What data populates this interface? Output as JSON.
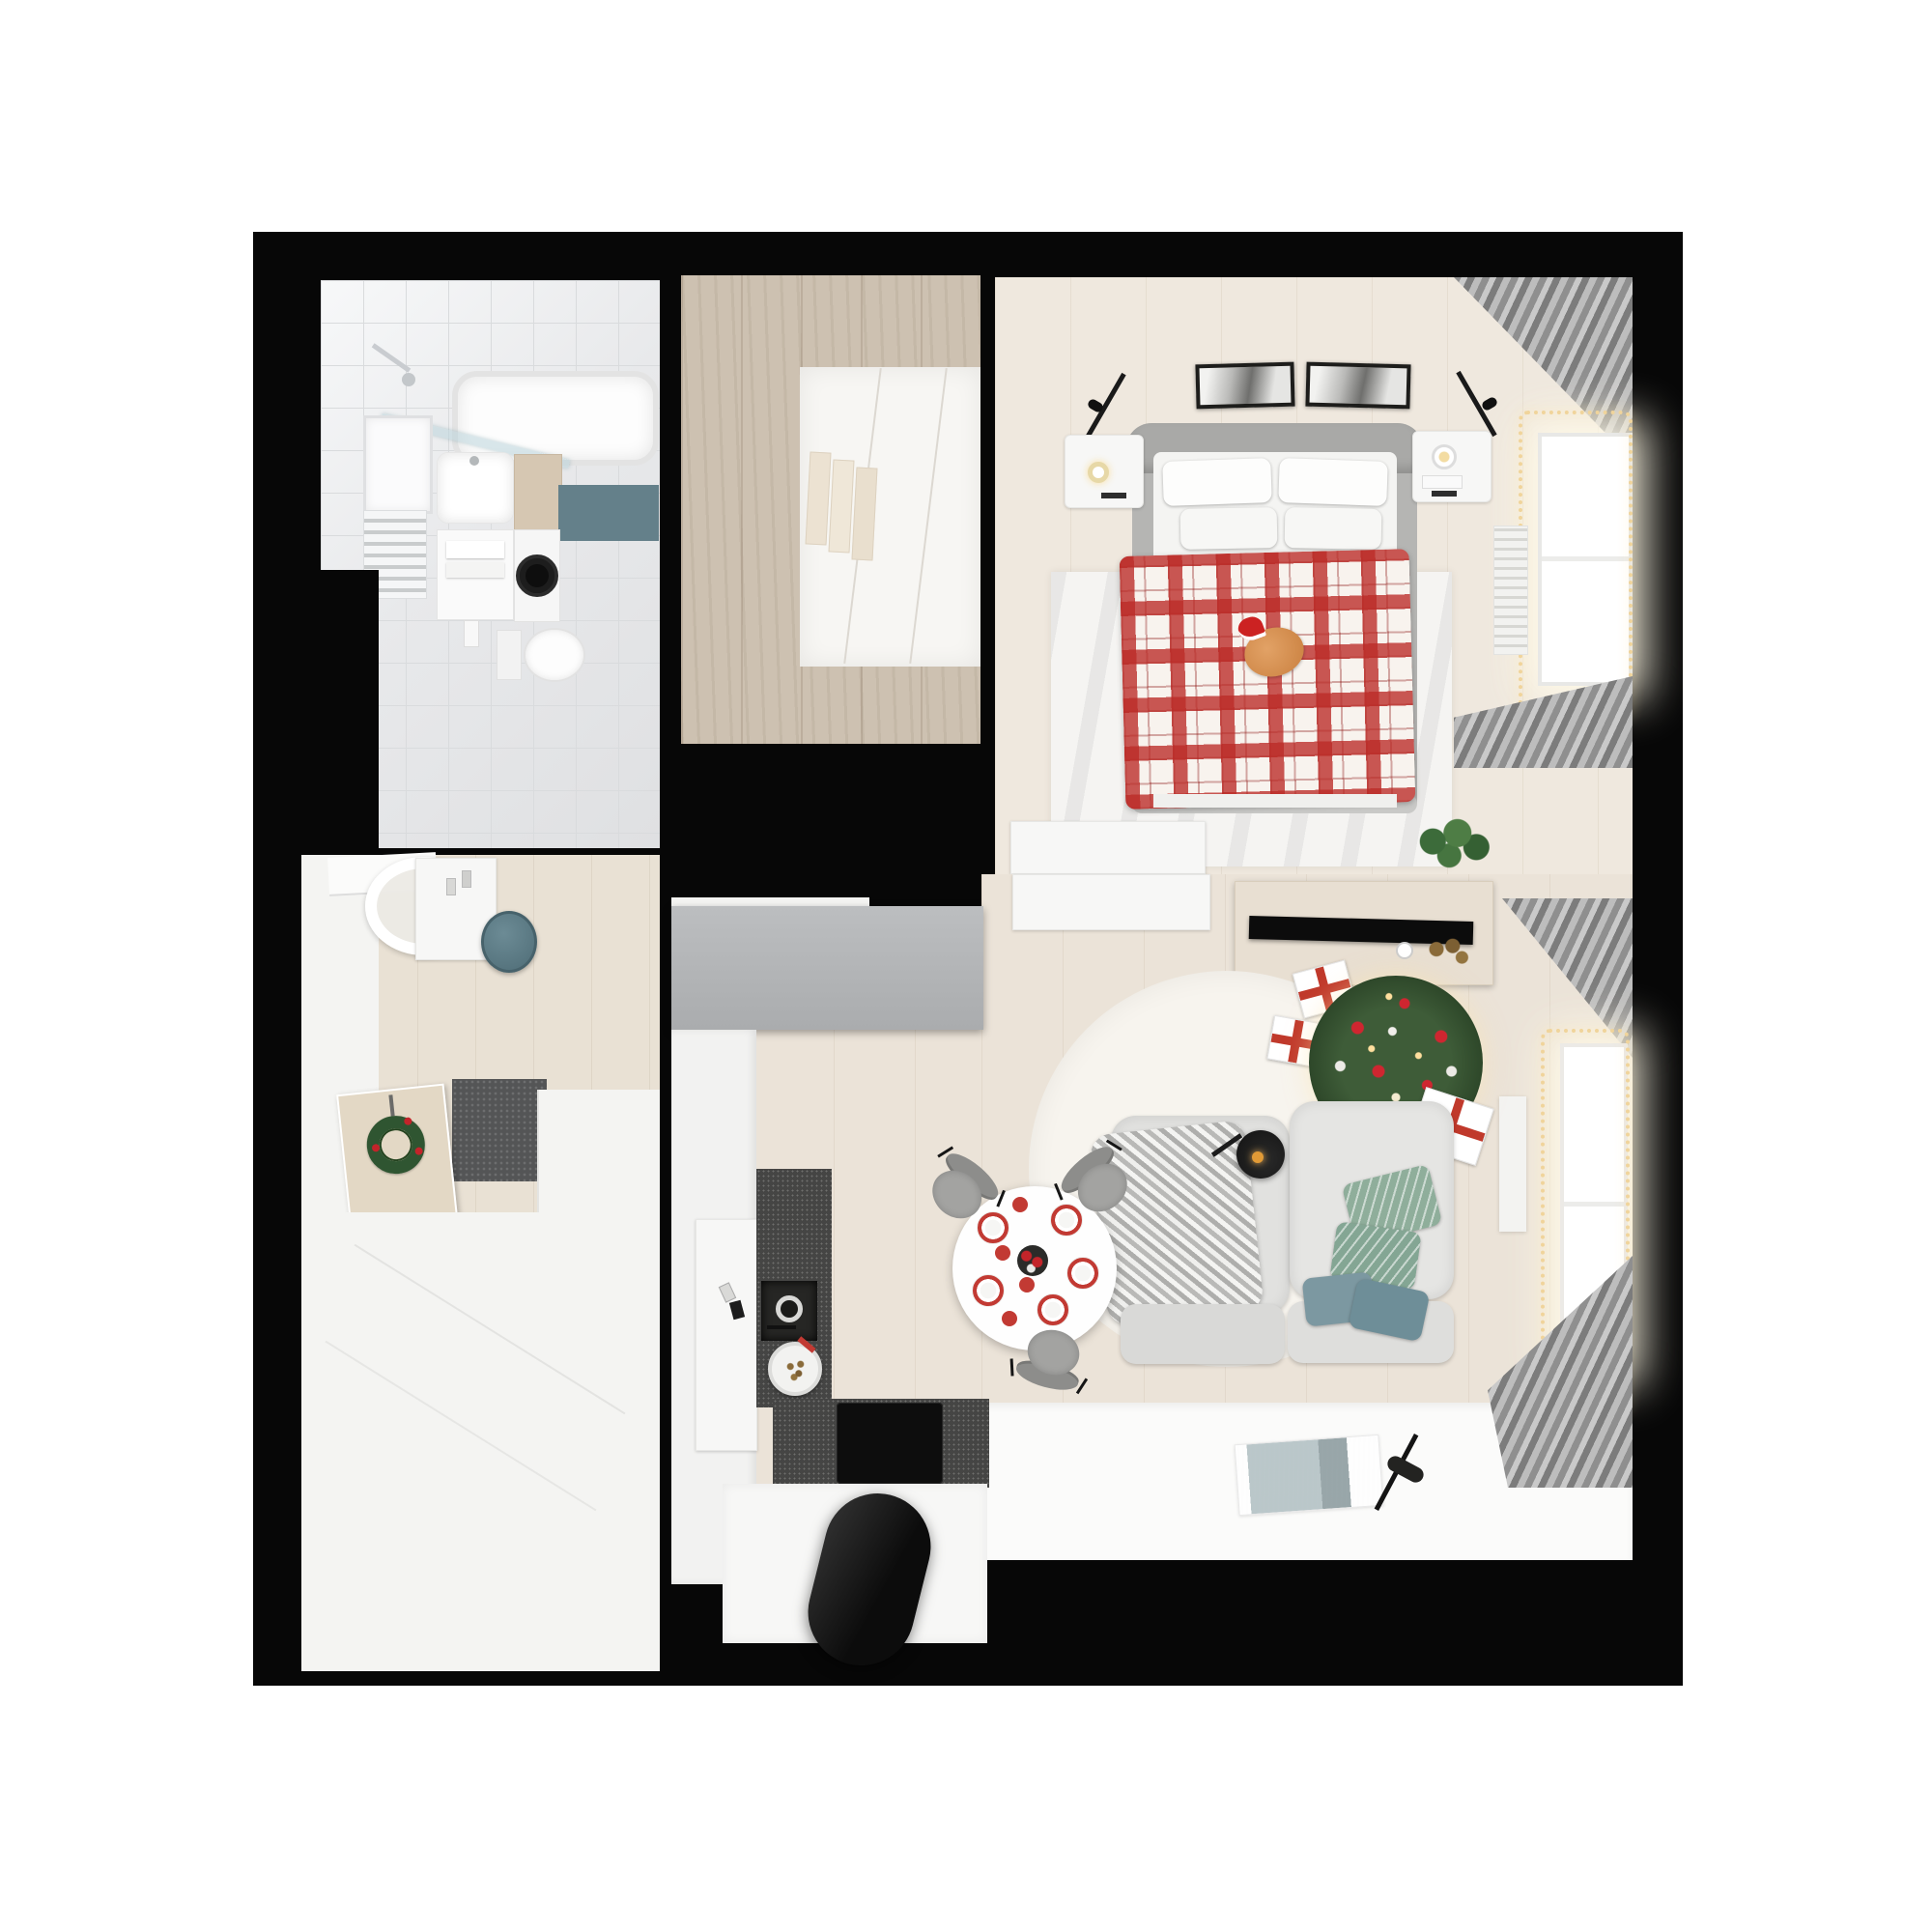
{
  "meta": {
    "kind": "3d-rendered-floor-plan",
    "view": "top-down",
    "theme": "small apartment decorated for christmas",
    "visible_text": "none"
  },
  "palette": {
    "page_background": "#ffffff",
    "wall_black": "#070707",
    "bathroom_tile": "#e8e9eb",
    "wardrobe_wood": "#cdc1b1",
    "bedroom_floor": "#efe8de",
    "living_floor": "#ebe3d8",
    "hall_floor": "#e9e1d4",
    "painted_white_floor": "#fbfbfa",
    "kitchen_counter": "#454544",
    "appliance_black": "#0d0d0d",
    "accent_red": "#c0392b",
    "plaid_red": "#bb2a26",
    "teal_accent": "#5d7a84",
    "sage_green": "#8fae9b",
    "tree_green": "#2b4427",
    "furniture_gray": "#b4b6b8",
    "sofa_gray": "#e1e1df",
    "string_lights_gold": "#f0d49b",
    "cat_orange": "#d78f4f"
  },
  "rooms": [
    {
      "id": "bathroom",
      "label": "bathroom",
      "furniture": [
        "bathtub",
        "shower-glass-screen",
        "shower-head",
        "mirror",
        "washbasin",
        "vanity",
        "towel-radiator",
        "storage-cabinet",
        "washing-machine",
        "toilet",
        "teal-bath-mat",
        "light-switch"
      ]
    },
    {
      "id": "walk-in-closet",
      "label": "walk-in closet",
      "furniture": [
        "wardrobe-cabinets",
        "closet-interior",
        "hanging-clothes"
      ]
    },
    {
      "id": "bedroom",
      "label": "bedroom",
      "furniture": [
        "double-bed",
        "headboard",
        "pillows",
        "plaid-blanket",
        "cat-with-santa-hat",
        "nightstand-left",
        "candle",
        "nightstand-right",
        "table-lamp",
        "wall-art-frames",
        "wall-sconces",
        "area-rug",
        "window",
        "string-lights",
        "curtains",
        "radiator",
        "plant",
        "dresser"
      ]
    },
    {
      "id": "entrance-hall",
      "label": "entrance hall",
      "furniture": [
        "round-mirror",
        "console",
        "perfume-bottles",
        "teal-pouf",
        "doormat",
        "front-door",
        "christmas-wreath",
        "tall-white-wardrobe"
      ]
    },
    {
      "id": "living-room",
      "label": "living room",
      "furniture": [
        "gray-wardrobe",
        "white-sideboard",
        "tv-bench",
        "tv",
        "vase",
        "dried-flowers",
        "christmas-tree",
        "gift-boxes",
        "round-rug",
        "modular-sofa",
        "throw-blanket",
        "sofa-pillows",
        "floor-lamp",
        "dining-table",
        "table-setting",
        "dining-chairs",
        "art-print",
        "reading-lamp",
        "window",
        "string-lights",
        "curtains"
      ]
    },
    {
      "id": "kitchen",
      "label": "kitchen",
      "furniture": [
        "tall-cabinets",
        "cups",
        "dark-countertop",
        "sink",
        "cookie-plate",
        "induction-hob",
        "extractor-hood",
        "white-island"
      ]
    }
  ]
}
